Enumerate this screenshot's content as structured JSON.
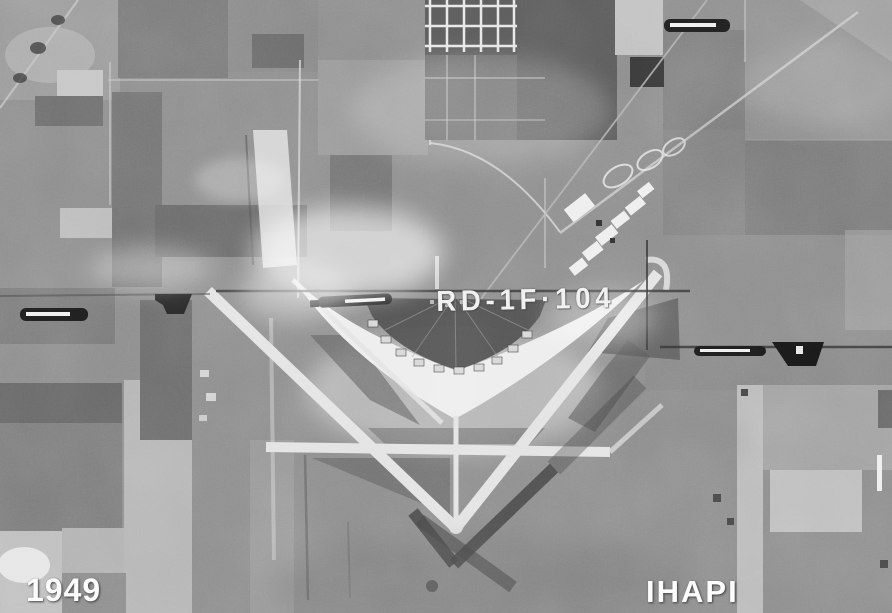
{
  "photo": {
    "year_label": "1949",
    "archive_label": "IHAPI",
    "frame_code": "RD-1F·104",
    "colors": {
      "label_text": "#fcfcfc",
      "apron_white": "#eeeeee",
      "fiducial_black": "#1f1f1f",
      "field_base": "#8e8e8e"
    }
  }
}
